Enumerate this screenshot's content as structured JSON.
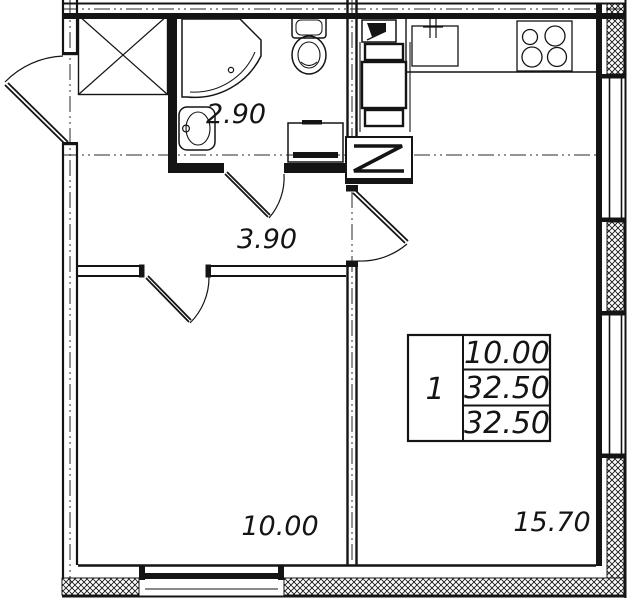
{
  "plan": {
    "type": "floor-plan",
    "colors": {
      "line": "#141414",
      "background": "#ffffff"
    },
    "labels": {
      "bathroom_area": "2.90",
      "hallway_area": "3.90",
      "bedroom_area": "10.00",
      "living_kitchen_area": "15.70"
    },
    "info_table": {
      "rooms_count": "1",
      "rows": [
        {
          "value": "10.00"
        },
        {
          "value": "32.50"
        },
        {
          "value": "32.50"
        }
      ]
    }
  }
}
